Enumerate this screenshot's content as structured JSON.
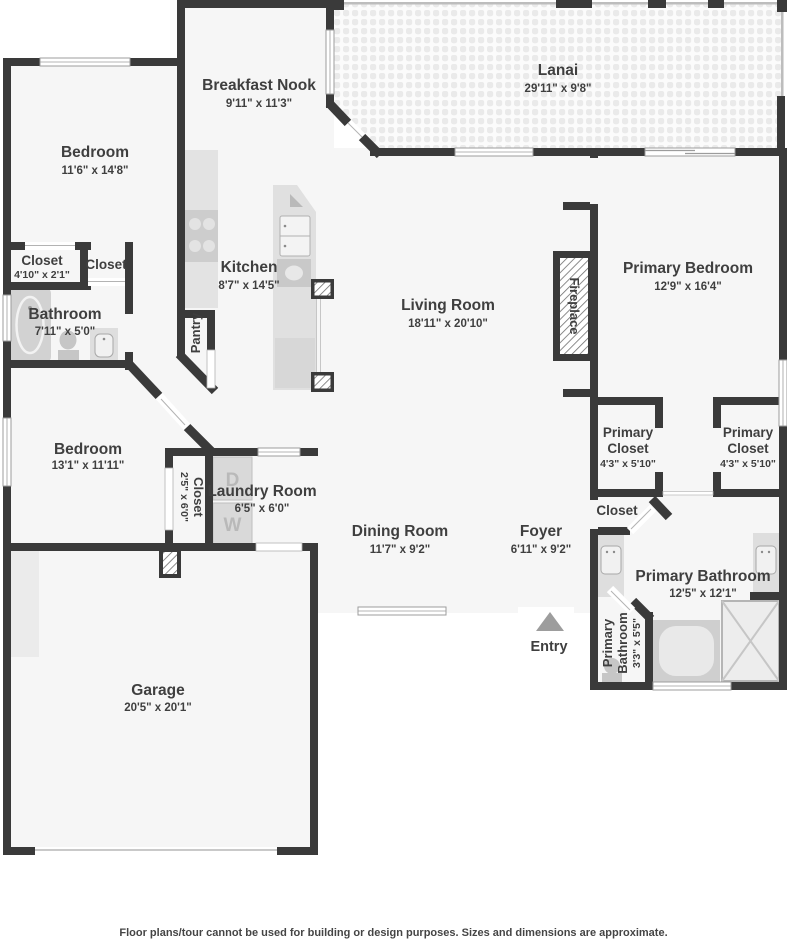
{
  "plan": {
    "disclaimer": "Floor plans/tour cannot be used for building or design purposes. Sizes and dimensions are approximate.",
    "rooms": {
      "breakfast_nook": {
        "name": "Breakfast Nook",
        "dims": "9'11\" x 11'3\""
      },
      "lanai": {
        "name": "Lanai",
        "dims": "29'11\" x 9'8\""
      },
      "bedroom_top": {
        "name": "Bedroom",
        "dims": "11'6\" x 14'8\""
      },
      "closet_a": {
        "name": "Closet",
        "dims": "4'10\" x 2'1\""
      },
      "closet_b": {
        "name": "Closet"
      },
      "bathroom": {
        "name": "Bathroom",
        "dims": "7'11\" x 5'0\""
      },
      "kitchen": {
        "name": "Kitchen",
        "dims": "8'7\" x 14'5\""
      },
      "pantry": {
        "name": "Pantry"
      },
      "living_room": {
        "name": "Living Room",
        "dims": "18'11\" x 20'10\""
      },
      "fireplace": {
        "name": "Fireplace"
      },
      "primary_bedroom": {
        "name": "Primary Bedroom",
        "dims": "12'9\" x 16'4\""
      },
      "primary_closet_left": {
        "line1": "Primary",
        "line2": "Closet",
        "dims": "4'3\" x 5'10\""
      },
      "primary_closet_right": {
        "line1": "Primary",
        "line2": "Closet",
        "dims": "4'3\" x 5'10\""
      },
      "hall_closet": {
        "name": "Closet"
      },
      "primary_bathroom": {
        "name": "Primary Bathroom",
        "dims": "12'5\" x 12'1\""
      },
      "primary_wc": {
        "line1": "Primary",
        "line2": "Bathroom",
        "dims": "3'3\" x 5'5\""
      },
      "bedroom_mid": {
        "name": "Bedroom",
        "dims": "13'1\" x 11'11\""
      },
      "closet_mid": {
        "name": "Closet",
        "dims": "2'5\" x 6'0\""
      },
      "laundry": {
        "name": "Laundry Room",
        "dims": "6'5\" x 6'0\""
      },
      "dining": {
        "name": "Dining Room",
        "dims": "11'7\" x 9'2\""
      },
      "foyer": {
        "name": "Foyer",
        "dims": "6'11\" x 9'2\""
      },
      "garage": {
        "name": "Garage",
        "dims": "20'5\" x 20'1\""
      },
      "entry": {
        "name": "Entry"
      }
    },
    "appliances": {
      "dryer": "D",
      "washer": "W"
    },
    "colors": {
      "wall": "#3a3a3a",
      "floor": "#f6f6f6",
      "label": "#3f3f3f",
      "fixture": "#d9d9d9"
    }
  }
}
